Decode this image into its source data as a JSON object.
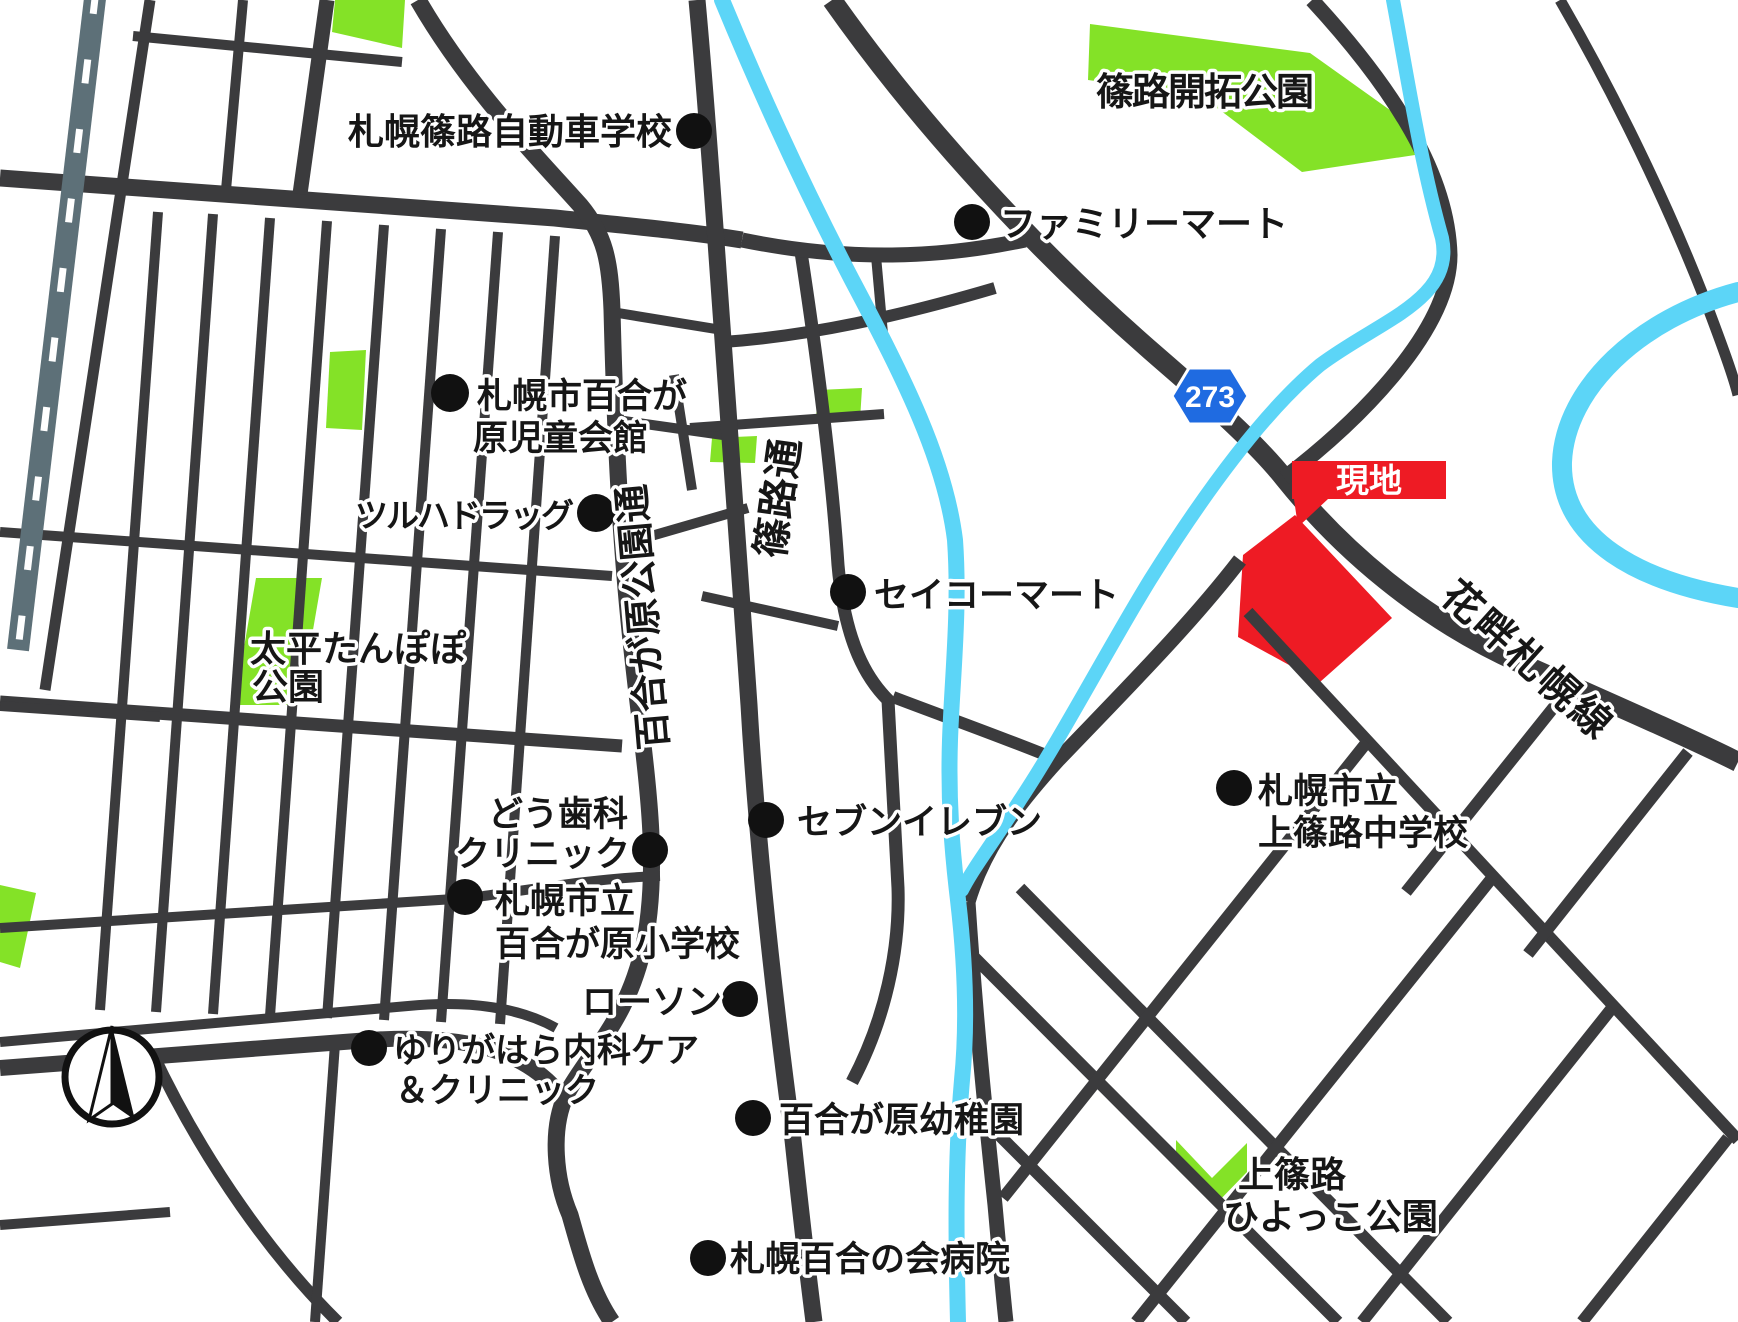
{
  "map": {
    "colors": {
      "road": "#3b3b3d",
      "railway": "#5d7078",
      "park_green": "#84e227",
      "river_blue": "#5cd5f7",
      "site_red": "#ee1b24",
      "route_shield_blue": "#1f6be1",
      "label_text": "#161616"
    },
    "route_shield": {
      "number": "273"
    },
    "site": {
      "banner_label": "現地"
    },
    "roads": {
      "yurigahara_koen_dori": "百合が原公園通",
      "shinoro_dori": "篠路通",
      "bannaguro_sapporo_line": "花畔札幌線"
    },
    "parks": {
      "shinoro_kaitaku": "篠路開拓公園",
      "taihei_tanpopo_line1": "太平たんぽぽ",
      "taihei_tanpopo_line2": "公園",
      "kamishinoro_hiyokko_line1": "上篠路",
      "kamishinoro_hiyokko_line2": "ひよっこ公園"
    },
    "pois": {
      "driving_school": "札幌篠路自動車学校",
      "familymart": "ファミリーマート",
      "jidokaikan_line1": "札幌市百合が",
      "jidokaikan_line2": "原児童会館",
      "tsuruha": "ツルハドラッグ",
      "seicomart": "セイコーマート",
      "dou_dental_line1": "どう歯科",
      "dou_dental_line2": "クリニック",
      "seven_eleven": "セブンイレブン",
      "elementary_line1": "札幌市立",
      "elementary_line2": "百合が原小学校",
      "lawson": "ローソン",
      "clinic_line1": "ゆりがはら内科ケア",
      "clinic_line2": "＆クリニック",
      "kindergarten": "百合が原幼稚園",
      "junior_high_line1": "札幌市立",
      "junior_high_line2": "上篠路中学校",
      "hospital": "札幌百合の会病院"
    }
  }
}
